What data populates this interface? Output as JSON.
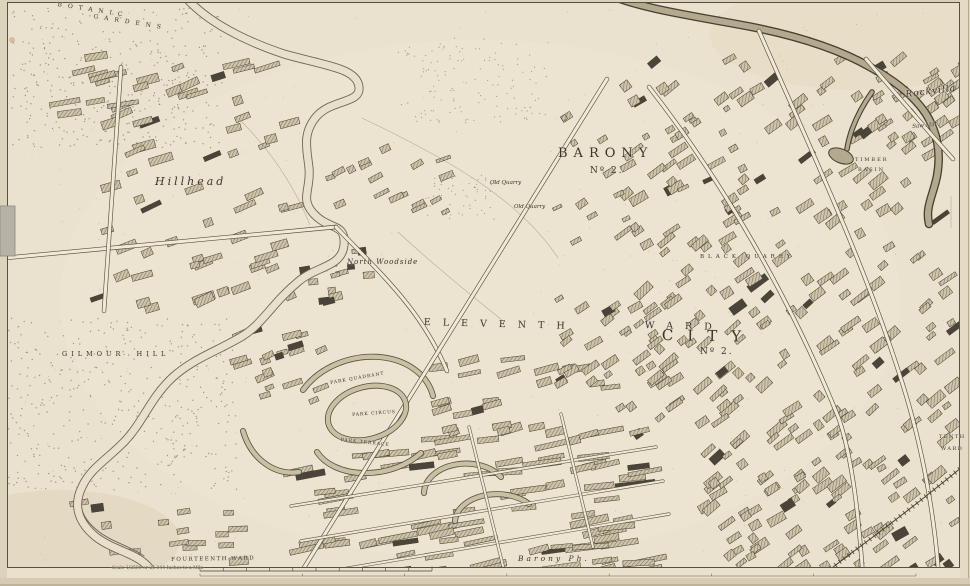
{
  "labels": [
    {
      "text": "BOTANIC"
    },
    {
      "text": "GARDENS"
    },
    {
      "text": "Hillhead"
    },
    {
      "text": "North Woodside"
    },
    {
      "text": "BARONY"
    },
    {
      "text": "Nº 2."
    },
    {
      "text": "ELEVENTH"
    },
    {
      "text": "WARD"
    },
    {
      "text": "CITY"
    },
    {
      "text": "Nº 2."
    },
    {
      "text": "FOURTEENTH WARD"
    },
    {
      "text": "Barony Ph."
    },
    {
      "text": "GILMOUR HILL"
    },
    {
      "text": "PARK QUADRANT"
    },
    {
      "text": "PARK CIRCUS"
    },
    {
      "text": "PARK TERRACE"
    },
    {
      "text": "Rockvilla"
    },
    {
      "text": "Saw Mill"
    },
    {
      "text": "TIMBER"
    },
    {
      "text": "BASIN"
    },
    {
      "text": "TENTH"
    },
    {
      "text": "WARD"
    },
    {
      "text": "Old Quarry"
    },
    {
      "text": "Old Quarry"
    },
    {
      "text": "BLACK QUARRY"
    },
    {
      "text": "Scale 1/2500 or 25·344 Inches to a Mile"
    }
  ],
  "palette": {
    "paper": "#EAE2CE",
    "ink": "#3a342c",
    "building_hatch": "#857b66",
    "building_dark": "#4a443a",
    "water_edge": "#6e6757",
    "canal_fill": "#b3a98f",
    "margin_edge": "#d6ccb4",
    "tab_grey": "#b6b2a7"
  },
  "map": {
    "paths": [
      {
        "name": "field-line-1",
        "type": "field",
        "d": "M362,118 C450,160 520,200 558,258"
      },
      {
        "name": "field-line-2",
        "type": "field",
        "d": "M398,232 C450,280 488,308 504,322"
      },
      {
        "name": "field-line-3",
        "type": "field",
        "d": "M240,120 C280,160 300,200 310,225"
      },
      {
        "name": "mill-lade",
        "type": "lade",
        "d": "M120,446 C102,464 90,472 84,488 C76,506 84,520 98,531 C112,542 130,546 144,556"
      },
      {
        "name": "river-kelvin",
        "type": "river",
        "d": "M183,-6 C205,22 248,42 284,54 C326,66 357,68 359,87 C361,104 331,99 316,117 C302,134 307,149 309,168 C311,190 300,198 313,213 C329,231 346,222 344,245 C342,267 317,266 299,281 C272,303 263,324 241,337 C215,352 193,359 173,377 C150,398 143,423 123,443 C105,461 90,469 82,487 C72,507 80,524 96,537 C112,549 130,552 143,562 C152,569 156,577 158,588"
      },
      {
        "name": "forth-clyde-canal",
        "type": "canal",
        "d": "M610,-5 C642,9 700,17 752,27 C802,37 842,51 870,67 C892,79 913,94 926,114 C938,133 941,154 937,176 C933,196 925,207 929,224"
      },
      {
        "name": "canal-basin-spur",
        "type": "spur",
        "d": "M872,92 C858,112 850,130 847,149"
      },
      {
        "name": "park-quadrant-crescent",
        "type": "arc",
        "d": "M303,390 A72,56 -15 0 1 433,396"
      },
      {
        "name": "park-terrace-row",
        "type": "arc",
        "d": "M317,452 A62,42 -10 0 0 421,453"
      },
      {
        "name": "queens-crescent-1",
        "type": "arc",
        "d": "M424,493 A42,30 0 0 1 501,477"
      },
      {
        "name": "queens-crescent-2",
        "type": "arc",
        "d": "M455,521 A42,28 0 0 1 529,504"
      },
      {
        "name": "woodside-crescent",
        "type": "arc",
        "d": "M243,431 A52,62 0 0 0 299,472"
      },
      {
        "name": "great-western-road",
        "type": "road",
        "d": "M5,258 L336,227"
      },
      {
        "name": "woodlands-road",
        "type": "road",
        "d": "M336,227 C381,274 421,309 447,371"
      },
      {
        "name": "byres-road",
        "type": "road",
        "d": "M121,67 L104,311"
      },
      {
        "name": "st-georges-road",
        "type": "road",
        "d": "M607,79 L297,579"
      },
      {
        "name": "new-city-road",
        "type": "road",
        "d": "M649,87 C721,179 791,299 839,419 C853,461 859,519 863,579"
      },
      {
        "name": "garscube-road",
        "type": "road",
        "d": "M759,31 C806,139 863,259 901,379 C923,447 935,519 939,579"
      },
      {
        "name": "possil-road",
        "type": "road",
        "d": "M866,59 C896,94 926,129 953,159"
      },
      {
        "name": "street-row-1",
        "type": "street",
        "d": "M291,506 L656,447"
      },
      {
        "name": "street-row-2",
        "type": "street",
        "d": "M301,541 L663,481"
      },
      {
        "name": "street-row-3",
        "type": "street",
        "d": "M319,573 L669,514"
      },
      {
        "name": "cross-street-1",
        "type": "street",
        "d": "M469,427 L503,566"
      },
      {
        "name": "cross-street-2",
        "type": "street",
        "d": "M561,414 L593,547"
      },
      {
        "name": "railway-line",
        "type": "rail",
        "d": "M968,462 C925,498 880,532 842,560 L822,576"
      }
    ],
    "clusters": [
      {
        "name": "rockvilla-blocks",
        "x": 852,
        "y": 52,
        "w": 112,
        "h": 96,
        "n": 26,
        "angle": -35,
        "wmin": 7,
        "wmax": 18,
        "hmin": 4,
        "hmax": 9
      },
      {
        "name": "right-city-north",
        "x": 618,
        "y": 58,
        "w": 330,
        "h": 200,
        "n": 95,
        "angle": -35,
        "wmin": 7,
        "wmax": 20,
        "hmin": 4,
        "hmax": 9
      },
      {
        "name": "right-city-mid",
        "x": 636,
        "y": 258,
        "w": 320,
        "h": 200,
        "n": 115,
        "angle": -38,
        "wmin": 7,
        "wmax": 22,
        "hmin": 4,
        "hmax": 9
      },
      {
        "name": "right-city-south",
        "x": 700,
        "y": 458,
        "w": 255,
        "h": 112,
        "n": 75,
        "angle": -35,
        "wmin": 7,
        "wmax": 20,
        "hmin": 4,
        "hmax": 9
      },
      {
        "name": "bottom-terraces",
        "x": 298,
        "y": 428,
        "w": 355,
        "h": 145,
        "n": 85,
        "angle": -9,
        "wmin": 16,
        "wmax": 40,
        "hmin": 4,
        "hmax": 7
      },
      {
        "name": "charing-cross-blocks",
        "x": 438,
        "y": 358,
        "w": 180,
        "h": 85,
        "n": 28,
        "angle": -12,
        "wmin": 10,
        "wmax": 26,
        "hmin": 4,
        "hmax": 8
      },
      {
        "name": "st-georges-blocks",
        "x": 556,
        "y": 296,
        "w": 120,
        "h": 115,
        "n": 38,
        "angle": -35,
        "wmin": 7,
        "wmax": 18,
        "hmin": 4,
        "hmax": 8
      },
      {
        "name": "hillhead-blocks",
        "x": 92,
        "y": 66,
        "w": 205,
        "h": 245,
        "n": 58,
        "angle": -20,
        "wmin": 8,
        "wmax": 24,
        "hmin": 4,
        "hmax": 9
      },
      {
        "name": "kelvin-north-blocks",
        "x": 330,
        "y": 148,
        "w": 120,
        "h": 72,
        "n": 18,
        "angle": -25,
        "wmin": 6,
        "wmax": 16,
        "hmin": 3,
        "hmax": 7
      },
      {
        "name": "woodside-mills",
        "x": 298,
        "y": 232,
        "w": 72,
        "h": 72,
        "n": 14,
        "angle": -10,
        "wmin": 6,
        "wmax": 14,
        "hmin": 4,
        "hmax": 8,
        "darkp": 0.5
      },
      {
        "name": "barony-villas",
        "x": 545,
        "y": 92,
        "w": 205,
        "h": 160,
        "n": 22,
        "angle": -30,
        "wmin": 5,
        "wmax": 12,
        "hmin": 3,
        "hmax": 7
      },
      {
        "name": "woodlands-blocks",
        "x": 238,
        "y": 328,
        "w": 95,
        "h": 85,
        "n": 20,
        "angle": -20,
        "wmin": 8,
        "wmax": 20,
        "hmin": 4,
        "hmax": 8
      },
      {
        "name": "kelvin-bottom-blocks",
        "x": 58,
        "y": 498,
        "w": 185,
        "h": 68,
        "n": 16,
        "angle": -5,
        "wmin": 8,
        "wmax": 20,
        "hmin": 4,
        "hmax": 8
      },
      {
        "name": "top-left-terraces",
        "x": 58,
        "y": 52,
        "w": 210,
        "h": 62,
        "n": 14,
        "angle": -12,
        "wmin": 14,
        "wmax": 34,
        "hmin": 4,
        "hmax": 7
      }
    ],
    "dotfields": [
      {
        "name": "botanic-gardens-trees",
        "x": 12,
        "y": 8,
        "w": 210,
        "h": 140,
        "n": 360,
        "r": 0.7,
        "o": 0.6
      },
      {
        "name": "gilmour-hill-trees",
        "x": 2,
        "y": 318,
        "w": 235,
        "h": 172,
        "n": 400,
        "r": 0.7,
        "o": 0.6
      },
      {
        "name": "mid-field-dots",
        "x": 398,
        "y": 38,
        "w": 150,
        "h": 85,
        "n": 130,
        "r": 0.6,
        "o": 0.55
      },
      {
        "name": "quarry-dots",
        "x": 425,
        "y": 175,
        "w": 70,
        "h": 45,
        "n": 60,
        "r": 0.6,
        "o": 0.55
      },
      {
        "name": "paper-speckles",
        "x": 10,
        "y": 5,
        "w": 940,
        "h": 560,
        "n": 260,
        "r": 0.45,
        "o": 0.4
      }
    ],
    "scalebar": {
      "x1": 200,
      "x2": 432,
      "y": 571,
      "divs": 10,
      "x1b": 200,
      "x2b": 916,
      "yb": 576,
      "divsb": 7
    }
  }
}
